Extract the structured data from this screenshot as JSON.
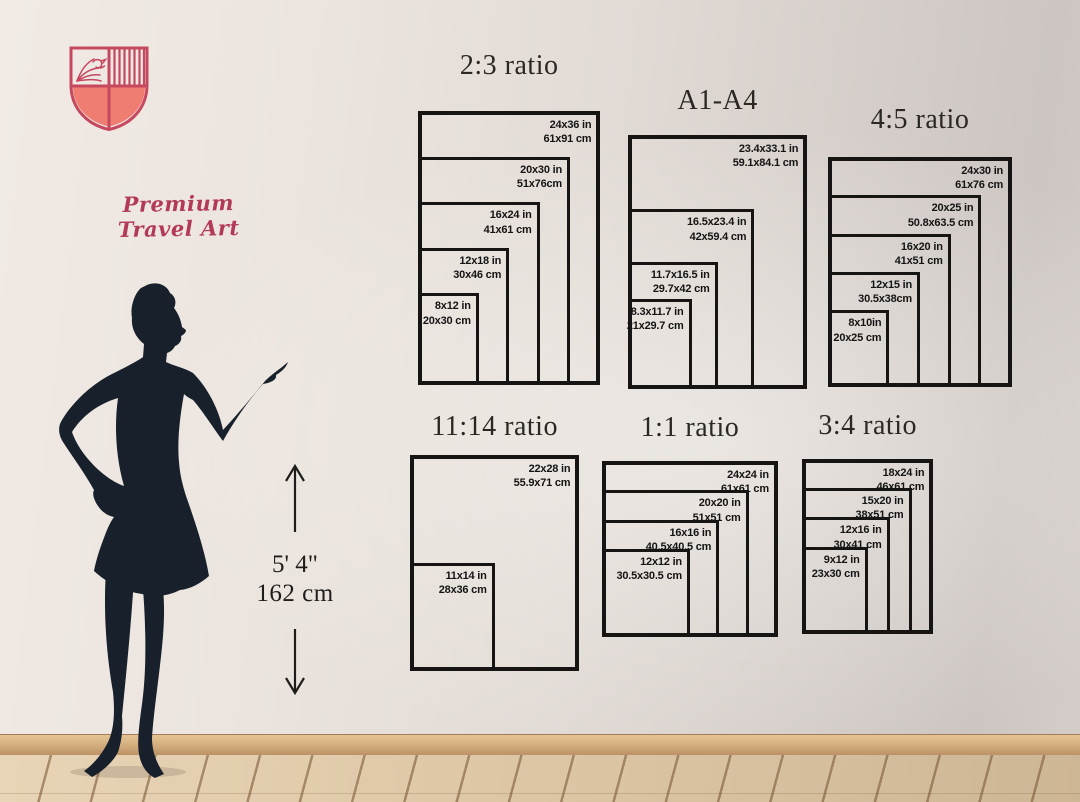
{
  "brand": {
    "name": "Premium Travel Art",
    "logo": "shield-crest-with-bird-and-stripes",
    "logo_outline_color": "#c5485f",
    "logo_fill_color": "#ef7d72",
    "name_color": "#b23a56"
  },
  "model": {
    "height_imperial": "5' 4\"",
    "height_metric": "162 cm",
    "silhouette_color": "#17202b"
  },
  "charts": [
    {
      "id": "ratio-2-3",
      "title": "2:3 ratio",
      "sizes": [
        {
          "inches": "24x36 in",
          "cm": "61x91 cm",
          "w_in": 24,
          "h_in": 36
        },
        {
          "inches": "20x30 in",
          "cm": "51x76cm",
          "w_in": 20,
          "h_in": 30
        },
        {
          "inches": "16x24 in",
          "cm": "41x61 cm",
          "w_in": 16,
          "h_in": 24
        },
        {
          "inches": "12x18 in",
          "cm": "30x46 cm",
          "w_in": 12,
          "h_in": 18
        },
        {
          "inches": "8x12 in",
          "cm": "20x30 cm",
          "w_in": 8,
          "h_in": 12
        }
      ]
    },
    {
      "id": "a-series",
      "title": "A1-A4",
      "sizes": [
        {
          "inches": "23.4x33.1 in",
          "cm": "59.1x84.1 cm",
          "w_in": 23.4,
          "h_in": 33.1
        },
        {
          "inches": "16.5x23.4 in",
          "cm": "42x59.4 cm",
          "w_in": 16.5,
          "h_in": 23.4
        },
        {
          "inches": "11.7x16.5 in",
          "cm": "29.7x42 cm",
          "w_in": 11.7,
          "h_in": 16.5
        },
        {
          "inches": "8.3x11.7 in",
          "cm": "21x29.7 cm",
          "w_in": 8.3,
          "h_in": 11.7
        }
      ]
    },
    {
      "id": "ratio-4-5",
      "title": "4:5 ratio",
      "sizes": [
        {
          "inches": "24x30 in",
          "cm": "61x76 cm",
          "w_in": 24,
          "h_in": 30
        },
        {
          "inches": "20x25 in",
          "cm": "50.8x63.5 cm",
          "w_in": 20,
          "h_in": 25
        },
        {
          "inches": "16x20 in",
          "cm": "41x51 cm",
          "w_in": 16,
          "h_in": 20
        },
        {
          "inches": "12x15 in",
          "cm": "30.5x38cm",
          "w_in": 12,
          "h_in": 15
        },
        {
          "inches": "8x10in",
          "cm": "20x25 cm",
          "w_in": 8,
          "h_in": 10
        }
      ]
    },
    {
      "id": "ratio-11-14",
      "title": "11:14 ratio",
      "sizes": [
        {
          "inches": "22x28 in",
          "cm": "55.9x71 cm",
          "w_in": 22,
          "h_in": 28
        },
        {
          "inches": "11x14 in",
          "cm": "28x36 cm",
          "w_in": 11,
          "h_in": 14
        }
      ]
    },
    {
      "id": "ratio-1-1",
      "title": "1:1 ratio",
      "sizes": [
        {
          "inches": "24x24 in",
          "cm": "61x61 cm",
          "w_in": 24,
          "h_in": 24
        },
        {
          "inches": "20x20 in",
          "cm": "51x51 cm",
          "w_in": 20,
          "h_in": 20
        },
        {
          "inches": "16x16 in",
          "cm": "40.5x40.5 cm",
          "w_in": 16,
          "h_in": 16
        },
        {
          "inches": "12x12 in",
          "cm": "30.5x30.5 cm",
          "w_in": 12,
          "h_in": 12
        }
      ]
    },
    {
      "id": "ratio-3-4",
      "title": "3:4 ratio",
      "sizes": [
        {
          "inches": "18x24 in",
          "cm": "46x61 cm",
          "w_in": 18,
          "h_in": 24
        },
        {
          "inches": "15x20 in",
          "cm": "38x51 cm",
          "w_in": 15,
          "h_in": 20
        },
        {
          "inches": "12x16 in",
          "cm": "30x41 cm",
          "w_in": 12,
          "h_in": 16
        },
        {
          "inches": "9x12 in",
          "cm": "23x30 cm",
          "w_in": 9,
          "h_in": 12
        }
      ]
    }
  ],
  "scene": {
    "wall_color": "#e2dbd6",
    "baseboard_color": "#d2ab7c",
    "floor_color": "#dcc7a8",
    "frame_border_color": "#171513",
    "title_color": "#2b2823",
    "label_color": "#141414"
  }
}
